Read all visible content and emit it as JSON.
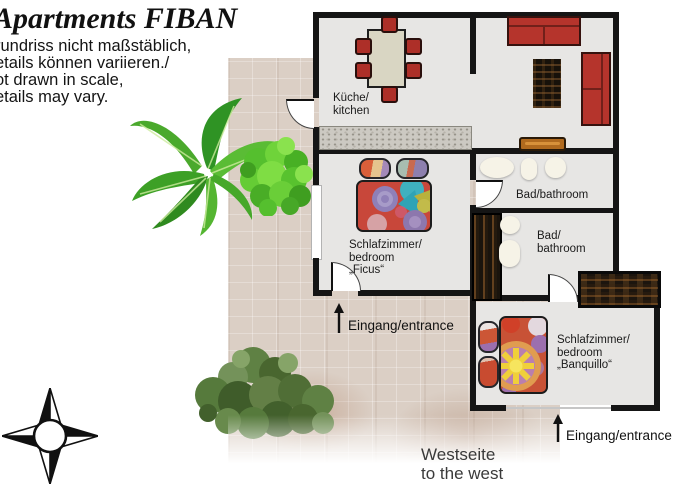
{
  "header": {
    "title": "Apartments FIBAN",
    "disclaimer_lines": [
      "rundriss nicht maßstäblich,",
      "etails können variieren./",
      "ot drawn in scale,",
      "etails may vary."
    ]
  },
  "plan": {
    "labels": {
      "kitchen": "Küche/\nkitchen",
      "bathroom_top": "Bad/bathroom",
      "bathroom_bottom": "Bad/\nbathroom",
      "bedroom_ficus": "Schlafzimmer/\nbedroom „Ficus“",
      "bedroom_banquillo": "Schlafzimmer/\nbedroom\n„Banquillo“",
      "entrance_1": "Eingang/entrance",
      "entrance_2": "Eingang/entrance",
      "west_side": "Westseite\nto the west"
    },
    "furniture": [
      "dining-table",
      "dining-chairs",
      "kitchen-counter",
      "sofa",
      "sofa-2",
      "dark-rug",
      "tv-board",
      "bath-sink",
      "bath-toilet",
      "bath-bidet",
      "wardrobe",
      "double-bed-ficus",
      "single-bed-banquillo"
    ]
  },
  "icons": {
    "compass": "compass-rose",
    "arrow_up": "↑",
    "plants": [
      "banana-plant",
      "green-bush",
      "tree-top-view"
    ]
  },
  "colors": {
    "wall": "#151515",
    "floor": "#e7e6e4",
    "sofa_red": "#b5342c",
    "courtyard_tile": "#dbcfc5",
    "plant_green": "#54b531",
    "tree_olive": "#5f8144"
  }
}
